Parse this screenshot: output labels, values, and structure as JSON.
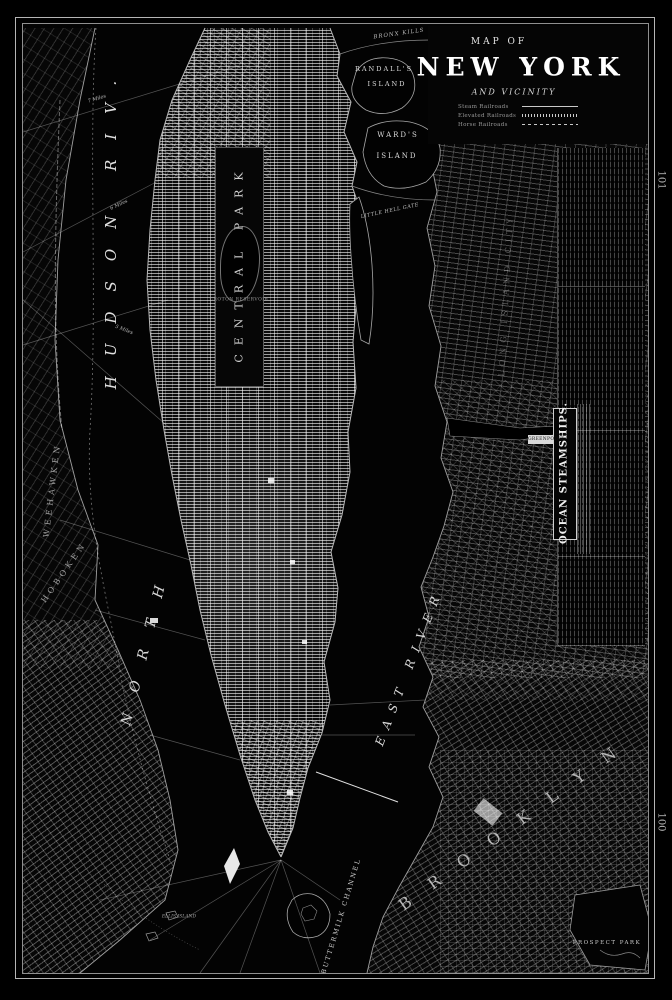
{
  "colors": {
    "paper": "#000000",
    "linework": "#c9c9c9",
    "bright": "#ffffff",
    "dim_land": "#2e2e2e"
  },
  "page": {
    "folio_top": "101",
    "folio_bottom": "100"
  },
  "title_block": {
    "kicker": "MAP OF",
    "title": "NEW YORK",
    "subtitle": "AND VICINITY",
    "legend": {
      "rows": [
        {
          "label": "Steam Railroads"
        },
        {
          "label": "Elevated Railroads"
        },
        {
          "label": "Horse Railroads"
        }
      ]
    }
  },
  "labels": {
    "hudson": "HUDSON RIV.",
    "north": "NORTH",
    "east_river": "EAST RIVER",
    "central_park": "CENTRAL PARK",
    "croton_reservoir": "CROTON RESERVOIR",
    "randalls_line1": "RANDALL'S",
    "randalls_line2": "ISLAND",
    "wards_line1": "WARD'S",
    "wards_line2": "ISLAND",
    "bronx_kills": "BRONX KILLS",
    "little_hell_gate": "LITTLE HELL GATE",
    "ocean_steamships": "OCEAN STEAMSHIPS.",
    "greenpoint": "GREENPOINT",
    "long_island_city": "LONG ISLAND CITY",
    "brooklyn": "BROOKLYN",
    "prospect_park": "PROSPECT PARK",
    "buttermilk_channel": "BUTTERMILK CHANNEL",
    "weehawken": "WEEHAWKEN",
    "hoboken": "HOBOKEN",
    "ellis_island": "ELLIS ISLAND",
    "miles_7": "7 Miles",
    "miles_6": "6 Miles",
    "miles_5": "5 Miles"
  }
}
